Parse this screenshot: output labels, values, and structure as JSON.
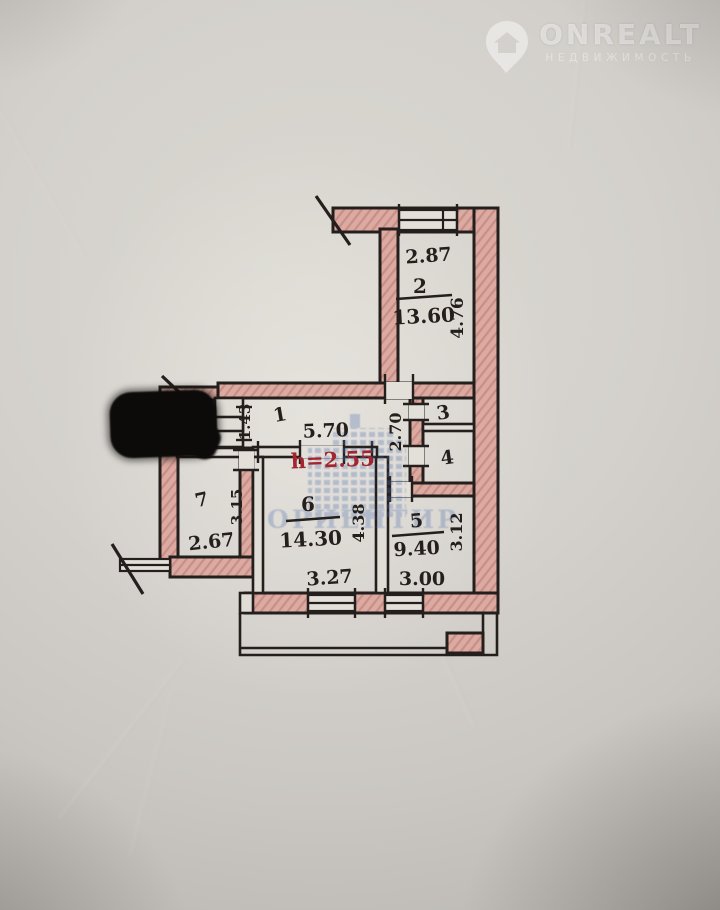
{
  "logo": {
    "brand": "ONREALT",
    "subtitle": "НЕДВИЖИМОСТЬ"
  },
  "watermark": {
    "agency_text": "ОРИЕНТИР"
  },
  "plan": {
    "ceiling_height_note": "h=2.55",
    "rooms": {
      "r1": {
        "number": "1",
        "dim_top": "5.70",
        "dim_side": "1.43"
      },
      "r2": {
        "number": "2",
        "area": "13.60",
        "dim_top": "2.87",
        "dim_side": "4.76"
      },
      "r3": {
        "number": "3"
      },
      "r4": {
        "number": "4"
      },
      "r5": {
        "number": "5",
        "area": "9.40",
        "dim_bottom": "3.00",
        "dim_side": "3.12"
      },
      "r6": {
        "number": "6",
        "area": "14.30",
        "dim_bottom": "3.27",
        "dim_side": "4.38"
      },
      "r7": {
        "number": "7",
        "dim_bottom": "2.67",
        "dim_side": "3.15"
      },
      "passage": {
        "dim_side": "2.70"
      }
    }
  },
  "colors": {
    "wall_fill": "#d9a49c",
    "line": "#241f1c",
    "height_note_red": "#a32530",
    "watermark_blue": "#4d6fae",
    "paper": "#d3d0cb"
  }
}
